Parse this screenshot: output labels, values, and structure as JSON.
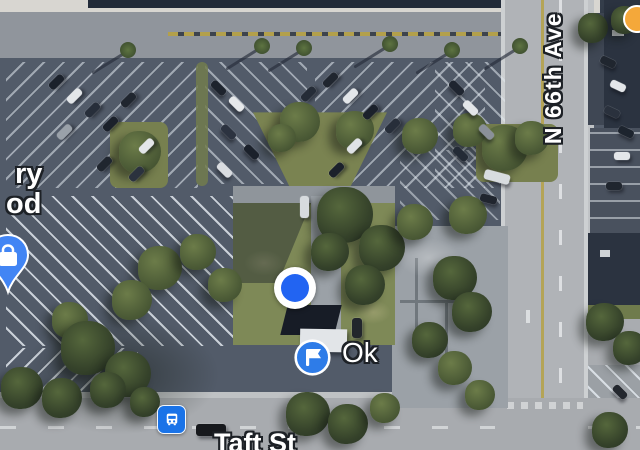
{
  "view": {
    "type": "satellite-map"
  },
  "labels": {
    "street_vertical": "N 66th Ave",
    "street_bottom": "Taft St",
    "parking_label": "Ok",
    "poi_fragment_line1": "ry",
    "poi_fragment_line2": "od"
  },
  "markers": {
    "location_dot_color": "#2264f2",
    "parking_icon_color": "#2e7ce8",
    "bus_icon_color": "#1a73e8",
    "store_pin_color": "#4285f4",
    "poi_dot_color": "#f4a83a",
    "label_text_color": "#ffffff",
    "label_outline_color": "#1d2126"
  },
  "scene": {
    "cars": [
      [
        48,
        78,
        17,
        8,
        -45,
        "#1b212b"
      ],
      [
        66,
        92,
        17,
        8,
        -45,
        "#e3e6e9"
      ],
      [
        84,
        106,
        17,
        8,
        -45,
        "#272e3a"
      ],
      [
        102,
        120,
        17,
        8,
        -45,
        "#1b212b"
      ],
      [
        56,
        128,
        17,
        8,
        -45,
        "#9aa1a9"
      ],
      [
        120,
        96,
        17,
        8,
        -45,
        "#20262f"
      ],
      [
        138,
        142,
        17,
        8,
        -45,
        "#e3e6e9"
      ],
      [
        96,
        160,
        17,
        8,
        -45,
        "#20262f"
      ],
      [
        128,
        170,
        17,
        8,
        -45,
        "#2b323e"
      ],
      [
        210,
        84,
        17,
        8,
        45,
        "#1d232d"
      ],
      [
        228,
        100,
        17,
        8,
        45,
        "#e6e8ea"
      ],
      [
        220,
        128,
        17,
        8,
        45,
        "#2c3340"
      ],
      [
        243,
        148,
        17,
        8,
        45,
        "#1b212b"
      ],
      [
        216,
        166,
        17,
        8,
        45,
        "#d9dce0"
      ],
      [
        322,
        76,
        17,
        8,
        -45,
        "#20262f"
      ],
      [
        342,
        92,
        17,
        8,
        -45,
        "#e3e6e9"
      ],
      [
        362,
        108,
        17,
        8,
        -45,
        "#1b212b"
      ],
      [
        384,
        122,
        17,
        8,
        -45,
        "#272e3a"
      ],
      [
        346,
        142,
        17,
        8,
        -45,
        "#dfe2e5"
      ],
      [
        328,
        166,
        17,
        8,
        -45,
        "#1b212b"
      ],
      [
        300,
        90,
        17,
        8,
        -45,
        "#252c37"
      ],
      [
        448,
        84,
        17,
        8,
        45,
        "#1f2530"
      ],
      [
        462,
        104,
        17,
        8,
        45,
        "#e3e6e9"
      ],
      [
        452,
        150,
        17,
        8,
        45,
        "#242b36"
      ],
      [
        478,
        128,
        17,
        8,
        45,
        "#8a9099"
      ],
      [
        484,
        172,
        26,
        10,
        15,
        "#d8dcdf"
      ],
      [
        480,
        195,
        17,
        8,
        15,
        "#20252e"
      ],
      [
        600,
        58,
        16,
        8,
        25,
        "#20262f"
      ],
      [
        610,
        82,
        16,
        8,
        25,
        "#e3e6e9"
      ],
      [
        604,
        108,
        16,
        8,
        25,
        "#2a313d"
      ],
      [
        618,
        128,
        16,
        8,
        25,
        "#1d242e"
      ],
      [
        614,
        152,
        16,
        8,
        0,
        "#e3e6e9"
      ],
      [
        606,
        182,
        16,
        8,
        0,
        "#20262f"
      ],
      [
        300,
        196,
        9,
        22,
        0,
        "#d7dbde"
      ],
      [
        352,
        318,
        10,
        20,
        0,
        "#22262c"
      ],
      [
        196,
        424,
        30,
        12,
        0,
        "#17191d"
      ],
      [
        612,
        388,
        16,
        8,
        45,
        "#23272e"
      ]
    ],
    "trees": [
      [
        140,
        152,
        42,
        0
      ],
      [
        300,
        122,
        40,
        0
      ],
      [
        355,
        130,
        38,
        0
      ],
      [
        282,
        138,
        28,
        0
      ],
      [
        505,
        148,
        46,
        0
      ],
      [
        532,
        138,
        34,
        0
      ],
      [
        470,
        130,
        34,
        0
      ],
      [
        420,
        136,
        36,
        0
      ],
      [
        160,
        268,
        44,
        0
      ],
      [
        198,
        252,
        36,
        0
      ],
      [
        132,
        300,
        40,
        0
      ],
      [
        225,
        285,
        34,
        0
      ],
      [
        70,
        320,
        36,
        0
      ],
      [
        88,
        348,
        54,
        1
      ],
      [
        128,
        374,
        46,
        1
      ],
      [
        345,
        215,
        56,
        1
      ],
      [
        382,
        248,
        46,
        1
      ],
      [
        330,
        252,
        38,
        1
      ],
      [
        365,
        285,
        40,
        1
      ],
      [
        415,
        222,
        36,
        0
      ],
      [
        468,
        215,
        38,
        0
      ],
      [
        455,
        278,
        44,
        1
      ],
      [
        472,
        312,
        40,
        1
      ],
      [
        430,
        340,
        36,
        1
      ],
      [
        455,
        368,
        34,
        0
      ],
      [
        308,
        414,
        44,
        1
      ],
      [
        348,
        424,
        40,
        1
      ],
      [
        385,
        408,
        30,
        0
      ],
      [
        22,
        388,
        42,
        1
      ],
      [
        62,
        398,
        40,
        1
      ],
      [
        108,
        390,
        36,
        1
      ],
      [
        145,
        402,
        30,
        1
      ],
      [
        605,
        322,
        38,
        1
      ],
      [
        630,
        348,
        34,
        1
      ],
      [
        593,
        28,
        30,
        1
      ],
      [
        625,
        20,
        28,
        1
      ],
      [
        610,
        430,
        36,
        1
      ],
      [
        480,
        395,
        30,
        0
      ]
    ],
    "palms": [
      [
        128,
        50
      ],
      [
        262,
        46
      ],
      [
        304,
        48
      ],
      [
        390,
        44
      ],
      [
        452,
        50
      ],
      [
        520,
        46
      ]
    ]
  }
}
